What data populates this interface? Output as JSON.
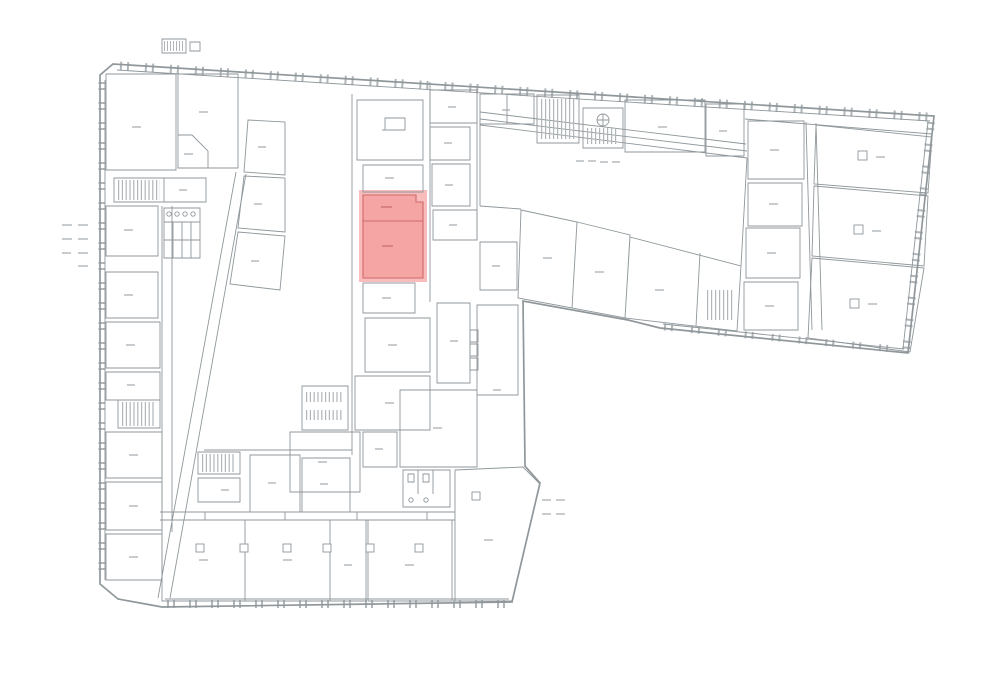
{
  "page": {
    "background": "#ffffff",
    "kind": "architectural-floor-plan",
    "visible_text": ""
  },
  "colors": {
    "wall": "#8f979b",
    "wall_light": "#b0b6ba",
    "label": "#939a9e",
    "highlight_fill": "#f5a3a3",
    "highlight_halo": "#f9bcbc",
    "highlight_stroke": "#d06a6a",
    "highlight_label": "#bb5f5f"
  },
  "highlight": {
    "rooms": 2,
    "location": "central strip, upper-middle of plan"
  },
  "annotations": {
    "left_margin_dash_rows": 4,
    "courtyard_dash_count": 4,
    "bottom_right_dash_rows": 2
  }
}
